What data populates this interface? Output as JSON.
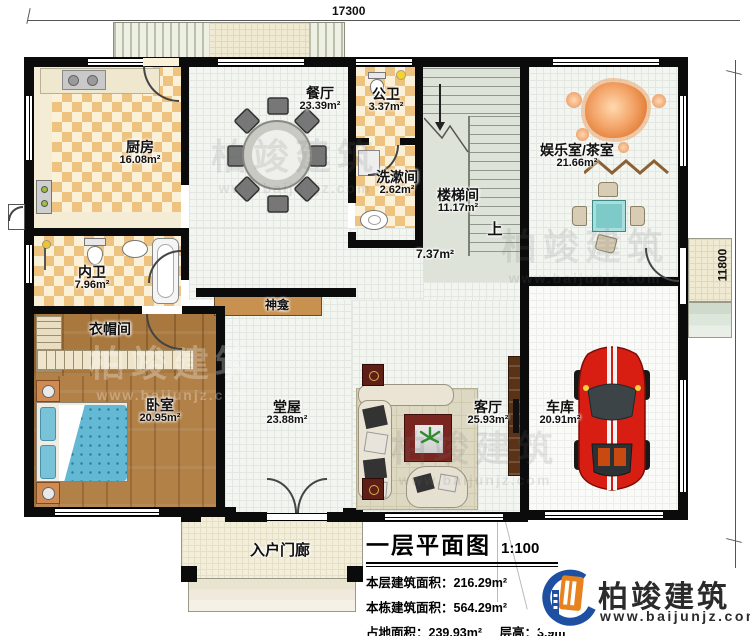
{
  "dimensions": {
    "top": "17300",
    "right": "11800",
    "bottom_right": "2000"
  },
  "rooms": {
    "kitchen": {
      "name": "厨房",
      "area": "16.08m²"
    },
    "dining": {
      "name": "餐厅",
      "area": "23.39m²"
    },
    "public_bath": {
      "name": "公卫",
      "area": "3.37m²"
    },
    "washroom": {
      "name": "洗漱间",
      "area": "2.62m²"
    },
    "stairwell": {
      "name": "楼梯间",
      "area": "11.17m²"
    },
    "tea_room": {
      "name": "娱乐室/茶室",
      "area": "21.66m²"
    },
    "inner_bath": {
      "name": "内卫",
      "area": "7.96m²"
    },
    "cloakroom": {
      "name": "衣帽间"
    },
    "bedroom": {
      "name": "卧室",
      "area": "20.95m²"
    },
    "hall": {
      "name": "堂屋",
      "area": "23.88m²"
    },
    "living": {
      "name": "客厅",
      "area": "25.93m²"
    },
    "garage": {
      "name": "车库",
      "area": "20.91m²"
    },
    "entry_porch": {
      "name": "入户门廊"
    },
    "shrine": {
      "name": "神龛"
    },
    "corridor_area": "7.37m²",
    "stairs_up": "上"
  },
  "legend": {
    "title": "一层平面图",
    "scale": "1:100",
    "line1": "本层建筑面积：216.29m²",
    "line2": "本栋建筑面积：564.29m²",
    "line3a": "占地面积：239.93m²",
    "line3b": "层高：3.9m"
  },
  "brand": {
    "name": "柏竣建筑",
    "url": "www.baijunjz.com"
  },
  "watermark": {
    "name": "柏竣建筑",
    "url": "www.baijunjz.com"
  },
  "colors": {
    "wall": "#0b0b0b",
    "checker": "#eec27f",
    "wood": "#a8783e",
    "car": "#d81e12",
    "tea_table": "#7ecac8",
    "logo_blue": "#1e4fa1",
    "logo_orange": "#e8821e"
  }
}
